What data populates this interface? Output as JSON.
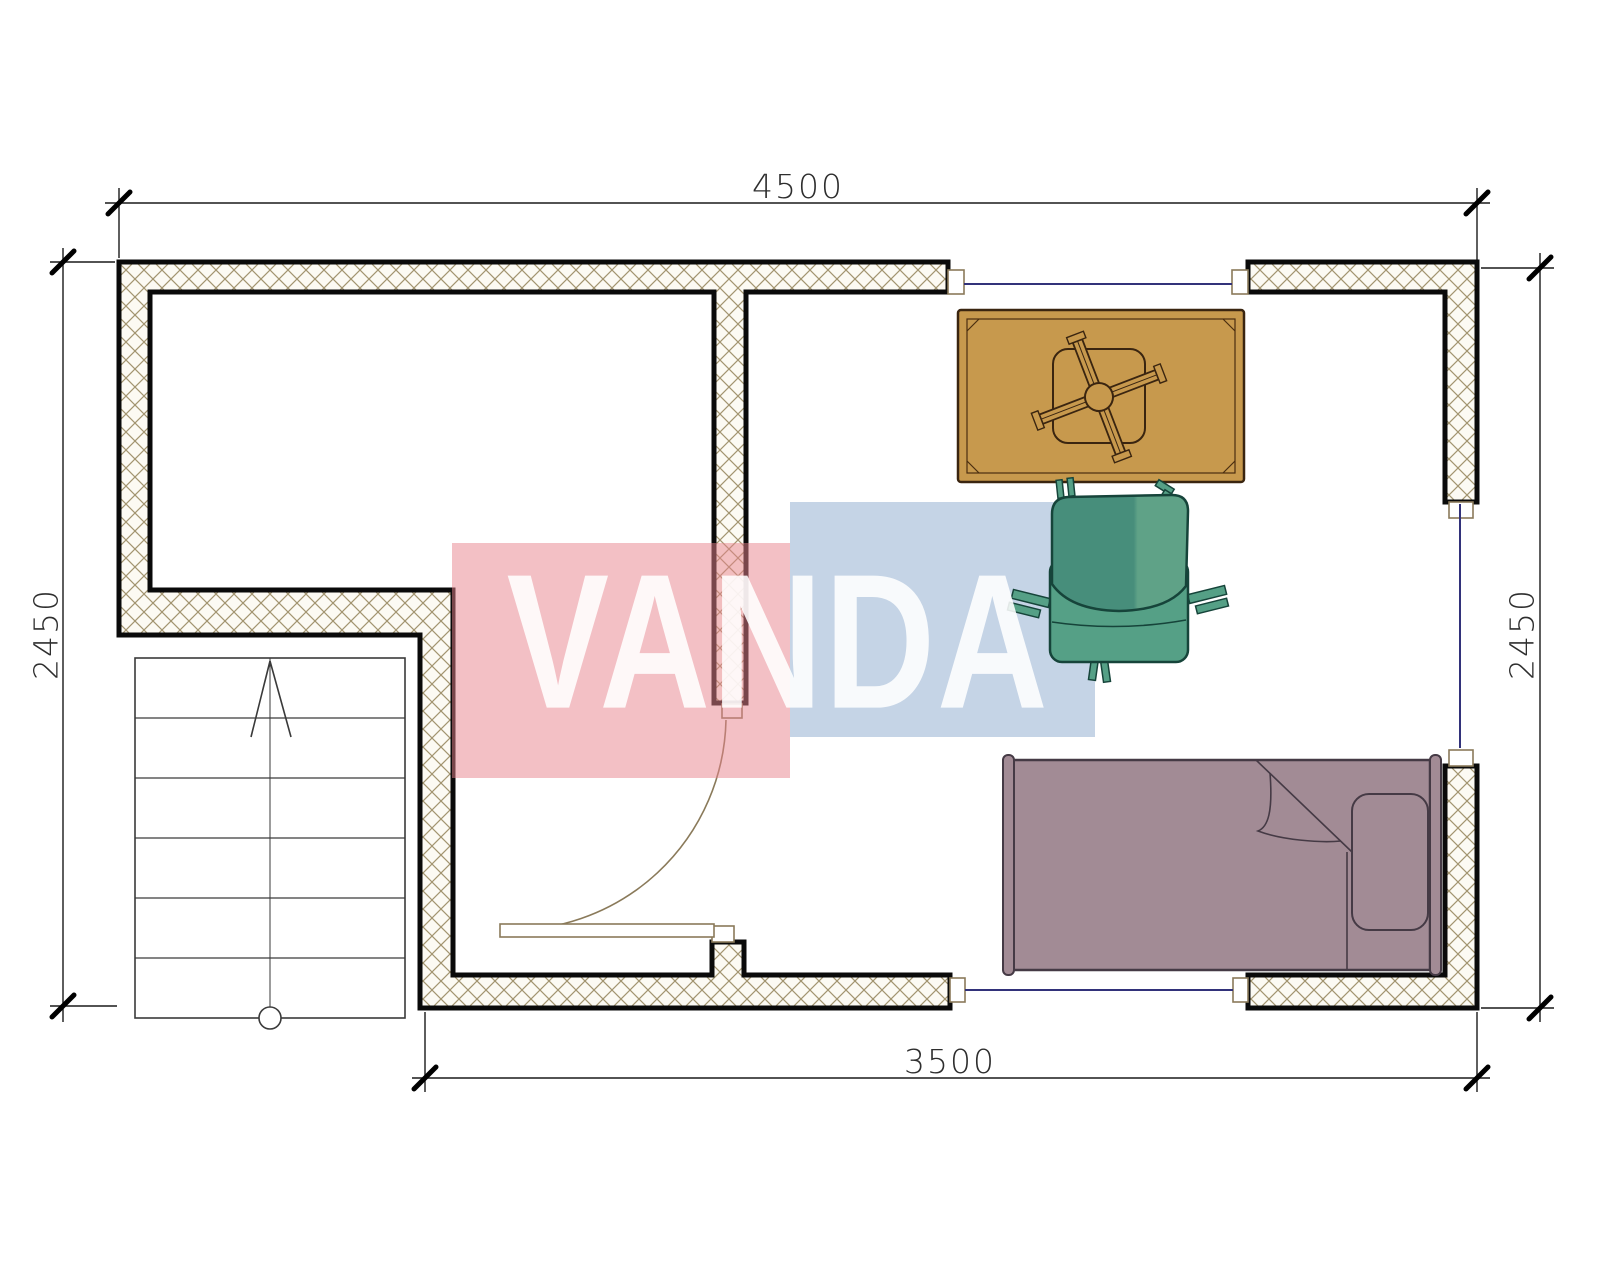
{
  "page": {
    "type": "architectural-floor-plan",
    "background": "#ffffff"
  },
  "dimensions": {
    "top": "4500",
    "bottom": "3500",
    "left": "2450",
    "right": "2450",
    "units": "mm"
  },
  "watermark": {
    "text": "VANDA",
    "red_block_color": "#e7828b",
    "blue_block_color": "#8caacd",
    "text_color": "#ffffff"
  },
  "colors": {
    "wall_outline": "#0a0a0a",
    "wall_hatch_line": "#a2946f",
    "wall_fill": "#fcfaf3",
    "window_line": "#32327a",
    "door_line": "#8a7a5a",
    "table_fill": "#c7994d",
    "table_outline": "#3a2510",
    "armchair_fill": "#4d957e",
    "armchair_outline": "#16443a",
    "bed_fill": "#a28b95",
    "bed_outline": "#453a45",
    "dimension_line": "#1a1a1a",
    "dimension_text": "#2e2e2e",
    "stairs_line": "#3a3a3a"
  },
  "stairs": {
    "tread_rows": 6,
    "has_direction_arrow": true
  },
  "furniture": [
    {
      "name": "table-with-fan-cross"
    },
    {
      "name": "armchair"
    },
    {
      "name": "single-bed-with-pillow"
    }
  ],
  "openings": {
    "windows": 3,
    "doors": 1
  }
}
